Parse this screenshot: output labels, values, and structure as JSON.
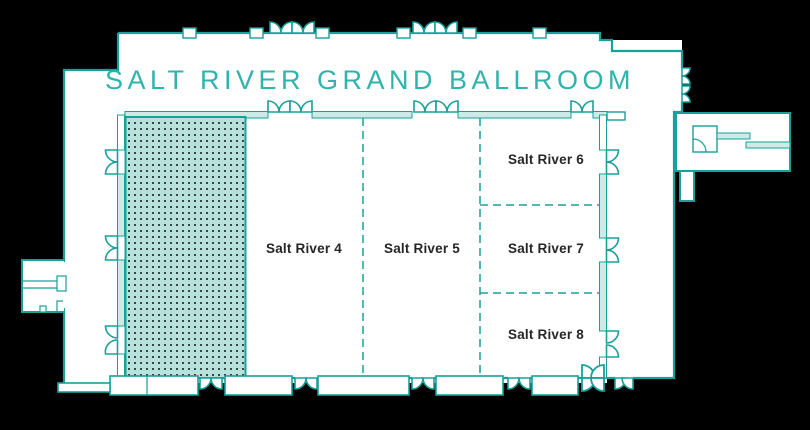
{
  "title": "SALT RIVER GRAND BALLROOM",
  "rooms": {
    "selected": {
      "label": "",
      "selected": true
    },
    "sr4": {
      "label": "Salt River 4",
      "selected": false
    },
    "sr5": {
      "label": "Salt River 5",
      "selected": false
    },
    "sr6": {
      "label": "Salt River 6",
      "selected": false
    },
    "sr7": {
      "label": "Salt River 7",
      "selected": false
    },
    "sr8": {
      "label": "Salt River 8",
      "selected": false
    }
  },
  "colors": {
    "background": "#000000",
    "wall_teal": "#18a099",
    "selected_fill": "#b9e1dc",
    "selected_dots": "#354644",
    "wall_fill_light": "#cdeae6",
    "title_teal": "#2eb4ad",
    "label_dark": "#262626",
    "floor_white": "#ffffff"
  }
}
